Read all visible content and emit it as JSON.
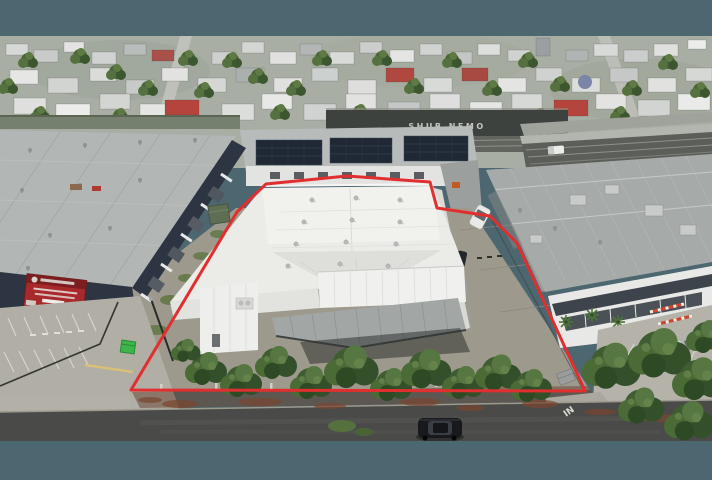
{
  "scene": {
    "description": "Aerial drone photograph of a commercial warehouse property outlined with a red boundary, surrounded by industrial buildings, a railway corridor and a suburban neighbourhood",
    "letterbox_color": "#4d6770"
  },
  "overlay": {
    "boundary_color": "#e12f2f",
    "boundary_stroke_width": "3",
    "boundary_points": "266,184 347,176 430,182 437,208 490,216 517,243 585,391 131,390 237,212"
  },
  "texts": {
    "graffiti": "SHUB NEMO",
    "road_marking": "IN"
  },
  "palette": {
    "white_roof": "#ebebe8",
    "grey_roof_left": "#b2b6b5",
    "grey_roof_right": "#a6aba9",
    "navy_wall": "#2d3442",
    "sign_red": "#a8292b",
    "solar_panel": "#1f2833",
    "foliage_dark": "#3c5a2e",
    "foliage_mid": "#4e6c3a",
    "foliage_light": "#64834a",
    "asphalt_road": "#4a4b48",
    "concrete": "#b2b0a7",
    "bin_green": "#3cb54a"
  }
}
